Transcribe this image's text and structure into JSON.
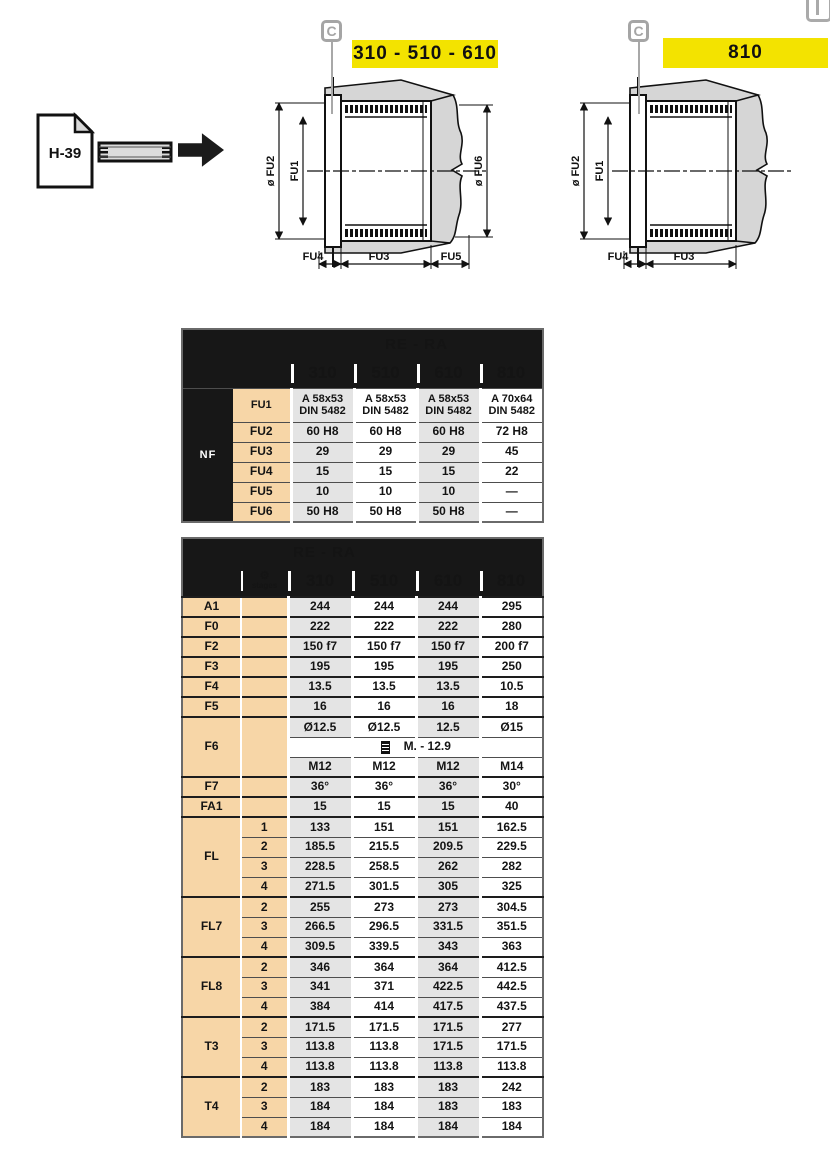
{
  "page_ref": {
    "label": "H-39"
  },
  "markers": {
    "letter": "C"
  },
  "diagrams": [
    {
      "title": "310 - 510 - 610",
      "dims": {
        "fu2": "ø FU2",
        "fu1": "FU1",
        "fu6": "ø FU6",
        "fu4": "FU4",
        "fu3": "FU3",
        "fu5": "FU5"
      }
    },
    {
      "title": "810",
      "dims": {
        "fu2": "ø FU2",
        "fu1": "FU1",
        "fu4": "FU4",
        "fu3": "FU3"
      }
    }
  ],
  "table1": {
    "group_title": "RE - RA",
    "side_label": "NF",
    "columns": [
      "310",
      "510",
      "610",
      "810"
    ],
    "rows": [
      {
        "label": "FU1",
        "values": [
          "A 58x53\nDIN 5482",
          "A 58x53\nDIN 5482",
          "A 58x53\nDIN 5482",
          "A 70x64\nDIN 5482"
        ]
      },
      {
        "label": "FU2",
        "values": [
          "60 H8",
          "60 H8",
          "60 H8",
          "72 H8"
        ]
      },
      {
        "label": "FU3",
        "values": [
          "29",
          "29",
          "29",
          "45"
        ]
      },
      {
        "label": "FU4",
        "values": [
          "15",
          "15",
          "15",
          "22"
        ]
      },
      {
        "label": "FU5",
        "values": [
          "10",
          "10",
          "10",
          "—"
        ]
      },
      {
        "label": "FU6",
        "values": [
          "50 H8",
          "50 H8",
          "50 H8",
          "—"
        ]
      }
    ]
  },
  "table2": {
    "group_title": "RE - RA",
    "stages_header": "stages",
    "stages_icon": "gear-icon",
    "columns": [
      "310",
      "510",
      "610",
      "810"
    ],
    "groups": [
      {
        "label": "A1",
        "rows": [
          {
            "stage": "",
            "values": [
              "244",
              "244",
              "244",
              "295"
            ]
          }
        ]
      },
      {
        "label": "F0",
        "rows": [
          {
            "stage": "",
            "values": [
              "222",
              "222",
              "222",
              "280"
            ]
          }
        ]
      },
      {
        "label": "F2",
        "rows": [
          {
            "stage": "",
            "values": [
              "150 f7",
              "150 f7",
              "150 f7",
              "200 f7"
            ]
          }
        ]
      },
      {
        "label": "F3",
        "rows": [
          {
            "stage": "",
            "values": [
              "195",
              "195",
              "195",
              "250"
            ]
          }
        ]
      },
      {
        "label": "F4",
        "rows": [
          {
            "stage": "",
            "values": [
              "13.5",
              "13.5",
              "13.5",
              "10.5"
            ]
          }
        ]
      },
      {
        "label": "F5",
        "rows": [
          {
            "stage": "",
            "values": [
              "16",
              "16",
              "16",
              "18"
            ]
          }
        ]
      },
      {
        "label": "F6",
        "rows": [
          {
            "stage": "",
            "values": [
              "Ø12.5",
              "Ø12.5",
              "12.5",
              "Ø15"
            ]
          },
          {
            "stage": "",
            "span_text": "M. - 12.9",
            "icon": "bolt-icon"
          },
          {
            "stage": "",
            "values": [
              "M12",
              "M12",
              "M12",
              "M14"
            ]
          }
        ]
      },
      {
        "label": "F7",
        "rows": [
          {
            "stage": "",
            "values": [
              "36°",
              "36°",
              "36°",
              "30°"
            ]
          }
        ]
      },
      {
        "label": "FA1",
        "rows": [
          {
            "stage": "",
            "values": [
              "15",
              "15",
              "15",
              "40"
            ]
          }
        ]
      },
      {
        "label": "FL",
        "rows": [
          {
            "stage": "1",
            "values": [
              "133",
              "151",
              "151",
              "162.5"
            ]
          },
          {
            "stage": "2",
            "values": [
              "185.5",
              "215.5",
              "209.5",
              "229.5"
            ]
          },
          {
            "stage": "3",
            "values": [
              "228.5",
              "258.5",
              "262",
              "282"
            ]
          },
          {
            "stage": "4",
            "values": [
              "271.5",
              "301.5",
              "305",
              "325"
            ]
          }
        ]
      },
      {
        "label": "FL7",
        "rows": [
          {
            "stage": "2",
            "values": [
              "255",
              "273",
              "273",
              "304.5"
            ]
          },
          {
            "stage": "3",
            "values": [
              "266.5",
              "296.5",
              "331.5",
              "351.5"
            ]
          },
          {
            "stage": "4",
            "values": [
              "309.5",
              "339.5",
              "343",
              "363"
            ]
          }
        ]
      },
      {
        "label": "FL8",
        "rows": [
          {
            "stage": "2",
            "values": [
              "346",
              "364",
              "364",
              "412.5"
            ]
          },
          {
            "stage": "3",
            "values": [
              "341",
              "371",
              "422.5",
              "442.5"
            ]
          },
          {
            "stage": "4",
            "values": [
              "384",
              "414",
              "417.5",
              "437.5"
            ]
          }
        ]
      },
      {
        "label": "T3",
        "rows": [
          {
            "stage": "2",
            "values": [
              "171.5",
              "171.5",
              "171.5",
              "277"
            ]
          },
          {
            "stage": "3",
            "values": [
              "113.8",
              "113.8",
              "171.5",
              "171.5"
            ]
          },
          {
            "stage": "4",
            "values": [
              "113.8",
              "113.8",
              "113.8",
              "113.8"
            ]
          }
        ]
      },
      {
        "label": "T4",
        "rows": [
          {
            "stage": "2",
            "values": [
              "183",
              "183",
              "183",
              "242"
            ]
          },
          {
            "stage": "3",
            "values": [
              "184",
              "184",
              "183",
              "183"
            ]
          },
          {
            "stage": "4",
            "values": [
              "184",
              "184",
              "184",
              "184"
            ]
          }
        ]
      }
    ]
  },
  "colors": {
    "accent_yellow": "#f3e300",
    "row_label_peach": "#f7d6a7",
    "column_gray": "#e4e4e4",
    "header_black": "#171717"
  }
}
